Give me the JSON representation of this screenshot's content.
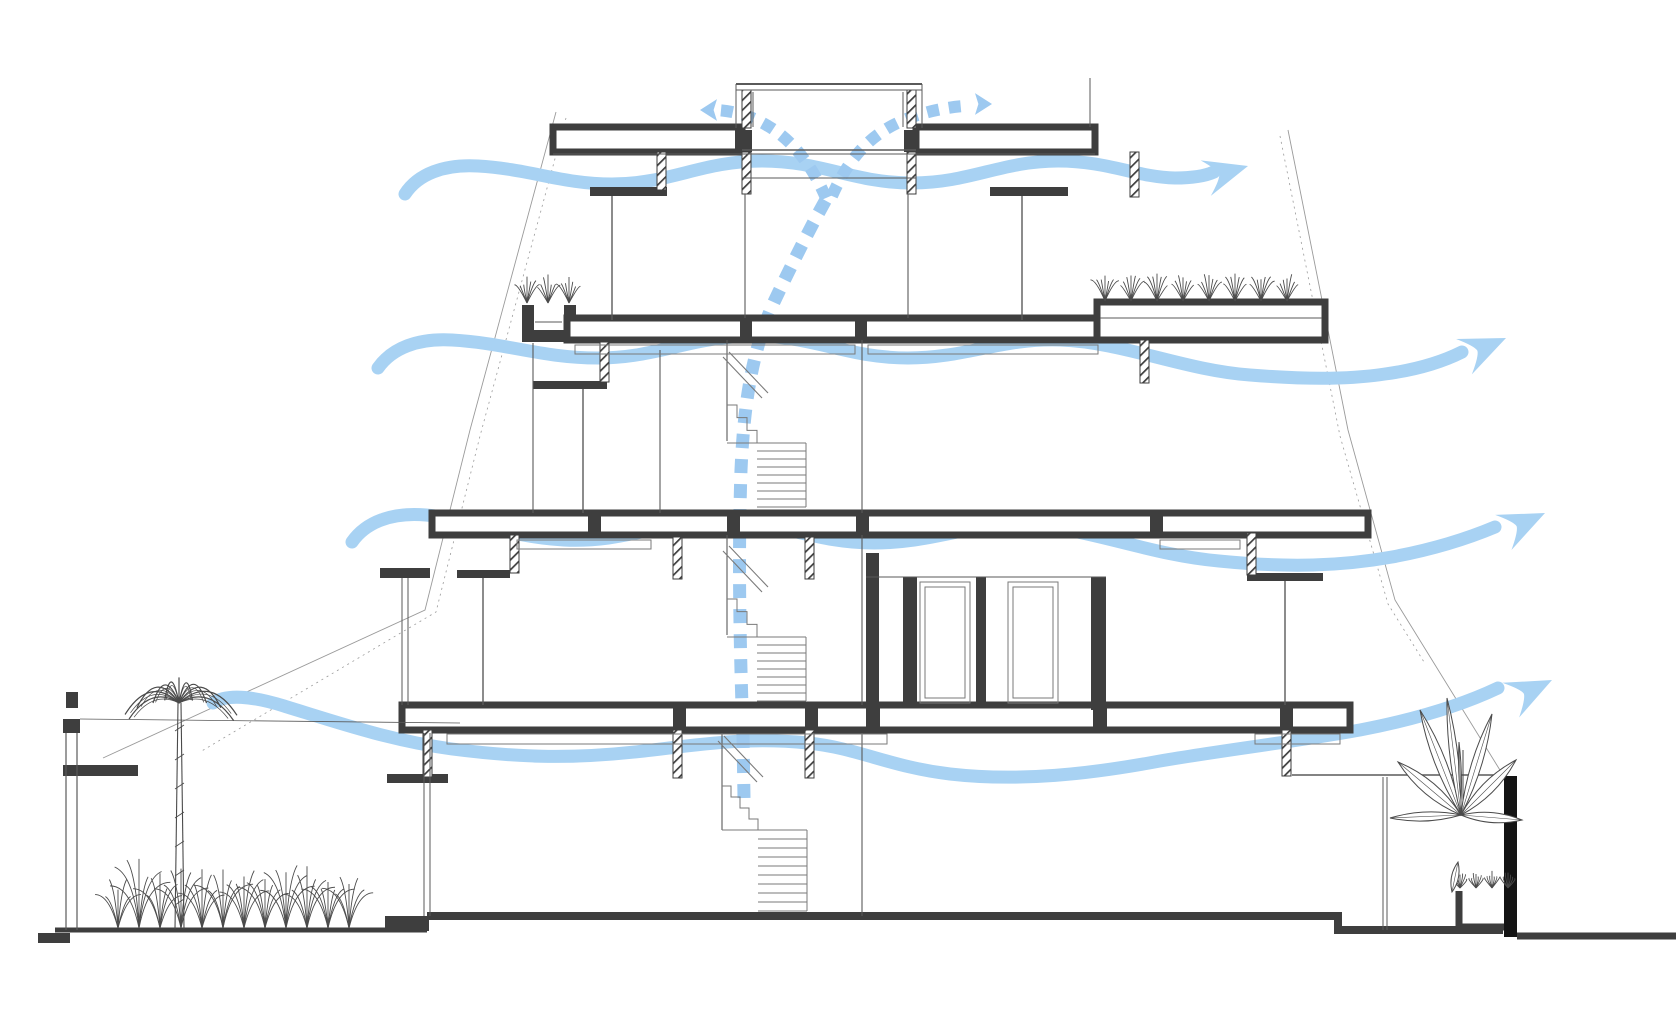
{
  "meta": {
    "title": "Building cross-section - natural ventilation diagram",
    "type": "architectural-section",
    "floors_shown": 4
  },
  "colors": {
    "background": "#FFFFFF",
    "airflow_wave": "#A8D2F3",
    "airflow_dash": "#9DC9F0",
    "structure_dark": "#3E3E3E",
    "wall_black": "#141414",
    "line_medium": "#5A5A5A",
    "line_light": "#9A9A9A",
    "stair_line": "#7A7A7A",
    "foliage": "#4A4A4A"
  },
  "airflows": {
    "waves": [
      {
        "name": "cross-ventilation-arrow-level-4",
        "d": "M405,194 C418,174 444,164 478,166 C530,169 562,184 612,184 C670,184 702,161 762,161 C822,161 854,183 912,183 C970,183 1002,161 1058,161 C1108,161 1136,177 1175,178 C1192,178 1205,176 1214,172",
        "head": {
          "x": 1248,
          "y": 166,
          "angle": -16,
          "size": 44
        }
      },
      {
        "name": "cross-ventilation-arrow-level-3",
        "d": "M378,368 C392,348 418,338 452,340 C506,343 542,358 598,358 C658,358 692,336 754,336 C814,336 848,358 908,358 C966,358 1002,338 1060,340 C1123,342 1183,370 1250,375 C1300,379 1345,380 1385,374 C1415,370 1442,362 1462,352",
        "head": {
          "x": 1506,
          "y": 338,
          "angle": -24,
          "size": 46
        }
      },
      {
        "name": "cross-ventilation-arrow-level-2",
        "d": "M352,542 C366,522 392,512 426,515 C472,519 508,537 564,540 C626,543 660,521 720,521 C780,521 814,543 874,543 C934,543 969,523 1026,525 C1089,528 1149,555 1219,561 C1289,568 1342,566 1392,557 C1430,550 1464,540 1495,527",
        "head": {
          "x": 1545,
          "y": 513,
          "angle": -25,
          "size": 46
        }
      },
      {
        "name": "cross-ventilation-arrow-ground",
        "d": "M213,703 C226,694 252,696 284,706 C336,722 388,740 452,749 C522,758 574,759 644,751 C704,744 748,737 808,743 C858,748 890,767 950,774 C1020,782 1090,774 1160,761 C1230,749 1300,741 1360,730 C1412,720 1460,706 1498,688",
        "head": {
          "x": 1552,
          "y": 680,
          "angle": -26,
          "size": 46
        }
      }
    ],
    "stack": {
      "name": "stack-ventilation-path",
      "vertical": "M744,798 L743,736 C740,650 738,560 741,470 C744,400 753,348 774,302 C792,264 812,224 828,196",
      "branch_left": "M826,198 C812,165 792,140 768,126 C752,116 734,111 716,110",
      "branch_right": "M832,196 C846,164 864,142 888,128 C908,116 938,108 964,106",
      "heads": [
        {
          "x": 700,
          "y": 110,
          "angle": 0,
          "size": 17
        },
        {
          "x": 992,
          "y": 104,
          "angle": 180,
          "size": 17
        }
      ]
    }
  },
  "drawing": {
    "slabs": [
      {
        "x": 553,
        "y": 127,
        "w": 189,
        "h": 25,
        "name": "roof-slab-left"
      },
      {
        "x": 916,
        "y": 127,
        "w": 179,
        "h": 25,
        "name": "roof-slab-right"
      },
      {
        "x": 567,
        "y": 318,
        "w": 533,
        "h": 22,
        "name": "floor-slab-level-3"
      },
      {
        "x": 1097,
        "y": 302,
        "w": 228,
        "h": 38,
        "name": "green-roof-terrace-slab"
      },
      {
        "x": 432,
        "y": 513,
        "w": 936,
        "h": 22,
        "name": "floor-slab-level-2"
      },
      {
        "x": 402,
        "y": 705,
        "w": 948,
        "h": 25,
        "name": "floor-slab-level-1"
      }
    ],
    "solids": [
      {
        "x": 735,
        "y": 130,
        "w": 17,
        "h": 22
      },
      {
        "x": 904,
        "y": 130,
        "w": 14,
        "h": 22
      },
      {
        "x": 740,
        "y": 318,
        "w": 12,
        "h": 22
      },
      {
        "x": 855,
        "y": 318,
        "w": 12,
        "h": 22
      },
      {
        "x": 588,
        "y": 513,
        "w": 13,
        "h": 22
      },
      {
        "x": 727,
        "y": 513,
        "w": 13,
        "h": 22
      },
      {
        "x": 856,
        "y": 513,
        "w": 13,
        "h": 22
      },
      {
        "x": 1150,
        "y": 513,
        "w": 13,
        "h": 22
      },
      {
        "x": 673,
        "y": 705,
        "w": 13,
        "h": 25
      },
      {
        "x": 805,
        "y": 705,
        "w": 13,
        "h": 25
      },
      {
        "x": 866,
        "y": 705,
        "w": 14,
        "h": 25
      },
      {
        "x": 1093,
        "y": 705,
        "w": 14,
        "h": 25
      },
      {
        "x": 1280,
        "y": 705,
        "w": 13,
        "h": 25
      },
      {
        "x": 590,
        "y": 187,
        "w": 77,
        "h": 9
      },
      {
        "x": 990,
        "y": 187,
        "w": 78,
        "h": 9
      },
      {
        "x": 533,
        "y": 381,
        "w": 74,
        "h": 8
      },
      {
        "x": 457,
        "y": 570,
        "w": 53,
        "h": 8
      },
      {
        "x": 380,
        "y": 568,
        "w": 50,
        "h": 10
      },
      {
        "x": 1247,
        "y": 573,
        "w": 76,
        "h": 8
      },
      {
        "x": 387,
        "y": 774,
        "w": 61,
        "h": 9
      },
      {
        "x": 866,
        "y": 553,
        "w": 13,
        "h": 154
      },
      {
        "x": 903,
        "y": 577,
        "w": 14,
        "h": 130
      },
      {
        "x": 976,
        "y": 577,
        "w": 10,
        "h": 130
      },
      {
        "x": 1091,
        "y": 577,
        "w": 15,
        "h": 133
      },
      {
        "x": 63,
        "y": 719,
        "w": 17,
        "h": 14
      },
      {
        "x": 66,
        "y": 692,
        "w": 12,
        "h": 16
      },
      {
        "x": 63,
        "y": 765,
        "w": 75,
        "h": 11
      },
      {
        "x": 38,
        "y": 933,
        "w": 32,
        "h": 10
      },
      {
        "x": 385,
        "y": 916,
        "w": 44,
        "h": 15
      },
      {
        "x": 1504,
        "y": 776,
        "w": 13,
        "h": 161,
        "black": true
      }
    ],
    "hatched": [
      {
        "x": 742,
        "y": 90,
        "w": 9,
        "h": 38
      },
      {
        "x": 907,
        "y": 90,
        "w": 9,
        "h": 38
      },
      {
        "x": 742,
        "y": 152,
        "w": 9,
        "h": 42
      },
      {
        "x": 907,
        "y": 152,
        "w": 9,
        "h": 42
      },
      {
        "x": 657,
        "y": 152,
        "w": 9,
        "h": 38
      },
      {
        "x": 1130,
        "y": 152,
        "w": 9,
        "h": 45
      },
      {
        "x": 600,
        "y": 342,
        "w": 9,
        "h": 40
      },
      {
        "x": 1140,
        "y": 340,
        "w": 9,
        "h": 43
      },
      {
        "x": 510,
        "y": 535,
        "w": 9,
        "h": 38
      },
      {
        "x": 673,
        "y": 537,
        "w": 9,
        "h": 42
      },
      {
        "x": 805,
        "y": 537,
        "w": 9,
        "h": 42
      },
      {
        "x": 1247,
        "y": 533,
        "w": 9,
        "h": 42
      },
      {
        "x": 423,
        "y": 730,
        "w": 9,
        "h": 47
      },
      {
        "x": 673,
        "y": 730,
        "w": 9,
        "h": 48
      },
      {
        "x": 805,
        "y": 730,
        "w": 9,
        "h": 48
      },
      {
        "x": 1282,
        "y": 730,
        "w": 9,
        "h": 46
      }
    ],
    "lines": [
      [
        736,
        84,
        922,
        84,
        2
      ],
      [
        736,
        90,
        922,
        90,
        1
      ],
      [
        736,
        84,
        736,
        128,
        1
      ],
      [
        922,
        84,
        922,
        128,
        1
      ],
      [
        753,
        92,
        753,
        127,
        1
      ],
      [
        903,
        92,
        903,
        127,
        1
      ],
      [
        742,
        150,
        916,
        150,
        1.4
      ],
      [
        742,
        178,
        916,
        178,
        1.1
      ],
      [
        1090,
        78,
        1090,
        127,
        1
      ],
      [
        553,
        154,
        1095,
        154,
        1
      ],
      [
        612,
        196,
        612,
        320,
        1.4
      ],
      [
        1022,
        196,
        1022,
        320,
        1.4
      ],
      [
        583,
        389,
        583,
        513,
        1.4
      ],
      [
        1285,
        581,
        1285,
        705,
        1.4
      ],
      [
        483,
        578,
        483,
        705,
        1.4
      ],
      [
        745,
        194,
        745,
        318,
        1.1
      ],
      [
        908,
        194,
        908,
        318,
        1.1
      ],
      [
        727,
        340,
        727,
        441,
        1.1
      ],
      [
        862,
        340,
        862,
        513,
        1.1
      ],
      [
        727,
        535,
        727,
        635,
        1.1
      ],
      [
        862,
        535,
        862,
        705,
        1.1
      ],
      [
        722,
        733,
        722,
        830,
        1.1
      ],
      [
        862,
        733,
        862,
        916,
        1.1
      ],
      [
        533,
        343,
        533,
        513,
        1.1
      ],
      [
        660,
        350,
        660,
        513,
        1.1
      ],
      [
        402,
        578,
        402,
        705,
        1
      ],
      [
        408,
        578,
        408,
        705,
        1
      ],
      [
        424,
        733,
        424,
        916,
        1
      ],
      [
        430,
        733,
        430,
        916,
        1
      ],
      [
        1292,
        775,
        1504,
        775,
        1.4
      ],
      [
        1383,
        777,
        1383,
        930,
        1
      ],
      [
        1387,
        777,
        1387,
        930,
        1
      ],
      [
        1100,
        318,
        1322,
        318,
        1
      ],
      [
        535,
        322,
        562,
        322,
        1
      ],
      [
        80,
        719,
        460,
        723,
        0.8
      ],
      [
        866,
        577,
        1106,
        577,
        1
      ],
      [
        66,
        733,
        66,
        930,
        1.2
      ],
      [
        77,
        733,
        77,
        930,
        1.2
      ]
    ],
    "boxes": [
      [
        575,
        345,
        280,
        9
      ],
      [
        868,
        345,
        230,
        9
      ],
      [
        517,
        540,
        134,
        9
      ],
      [
        1160,
        540,
        80,
        9
      ],
      [
        447,
        734,
        440,
        10
      ],
      [
        1255,
        734,
        85,
        10
      ],
      [
        920,
        582,
        50,
        121
      ],
      [
        925,
        587,
        40,
        111
      ],
      [
        1008,
        582,
        50,
        121
      ],
      [
        1013,
        587,
        40,
        111
      ]
    ],
    "planters": [
      {
        "pts": [
          [
            528,
            305
          ],
          [
            528,
            336
          ],
          [
            570,
            336
          ],
          [
            570,
            305
          ]
        ],
        "w": 12,
        "name": "balcony-planter-box"
      },
      {
        "pts": [
          [
            1459,
            891
          ],
          [
            1459,
            927
          ],
          [
            1512,
            927
          ]
        ],
        "w": 7,
        "name": "ground-planter-box"
      }
    ],
    "ground": [
      {
        "pts": [
          [
            427,
            916
          ],
          [
            1338,
            916
          ],
          [
            1338,
            930
          ],
          [
            1503,
            930
          ]
        ],
        "w": 8
      },
      {
        "pts": [
          [
            55,
            930
          ],
          [
            427,
            930
          ]
        ],
        "w": 5
      },
      {
        "pts": [
          [
            1517,
            936
          ],
          [
            1676,
            936
          ]
        ],
        "w": 7
      }
    ],
    "sight_lines": [
      {
        "pts": [
          [
            556,
            112
          ],
          [
            470,
            430
          ],
          [
            425,
            610
          ],
          [
            103,
            758
          ]
        ],
        "w": 0.9
      },
      {
        "pts": [
          [
            566,
            118
          ],
          [
            480,
            436
          ],
          [
            436,
            612
          ],
          [
            200,
            752
          ]
        ],
        "w": 0.8,
        "dash": "2 4"
      },
      {
        "pts": [
          [
            1288,
            130
          ],
          [
            1348,
            430
          ],
          [
            1395,
            600
          ],
          [
            1503,
            775
          ]
        ],
        "w": 0.9
      },
      {
        "pts": [
          [
            1280,
            136
          ],
          [
            1340,
            436
          ],
          [
            1388,
            604
          ],
          [
            1424,
            662
          ]
        ],
        "w": 0.8,
        "dash": "2 4"
      }
    ],
    "stairs": [
      {
        "name": "stair-flight-level-2",
        "x1": 757,
        "x2": 806,
        "yStart": 443,
        "yEnd": 507,
        "n": 8,
        "zigX": 727,
        "zigY": 405,
        "zigN": 3,
        "rail": [
          723,
          357,
          762,
          398
        ]
      },
      {
        "name": "stair-flight-level-1",
        "x1": 757,
        "x2": 806,
        "yStart": 637,
        "yEnd": 701,
        "n": 8,
        "zigX": 727,
        "zigY": 599,
        "zigN": 3,
        "rail": [
          723,
          551,
          762,
          592
        ]
      },
      {
        "name": "stair-flight-ground",
        "x1": 758,
        "x2": 807,
        "yStart": 830,
        "yEnd": 911,
        "n": 9,
        "zigX": 722,
        "zigY": 786,
        "zigN": 4,
        "rail": [
          718,
          741,
          757,
          782
        ]
      }
    ],
    "vegetation": {
      "palm": {
        "x": 179,
        "groundY": 929,
        "topY": 703,
        "frondR": 58,
        "fronds": 11
      },
      "shrub_row": {
        "x1": 118,
        "x2": 368,
        "baseY": 928,
        "spacing": 21
      },
      "roof_tufts": {
        "x1": 1105,
        "x2": 1312,
        "baseY": 301,
        "spacing": 26,
        "h": 27
      },
      "planter_tufts": {
        "x1": 527,
        "x2": 572,
        "baseY": 303,
        "spacing": 21,
        "h": 25
      },
      "rim_tufts": {
        "x1": 1460,
        "x2": 1510,
        "baseY": 888,
        "spacing": 16,
        "h": 15
      },
      "banana": {
        "stemX": 1461,
        "stemTop": 750,
        "stemBase": 815,
        "base": [
          1461,
          815
        ],
        "leaves": [
          [
            1398,
            762,
            13
          ],
          [
            1420,
            710,
            11
          ],
          [
            1447,
            698,
            8
          ],
          [
            1492,
            714,
            10
          ],
          [
            1516,
            760,
            12
          ],
          [
            1390,
            818,
            9
          ],
          [
            1522,
            820,
            10
          ]
        ],
        "bulb": [
          [
            1458,
            862
          ],
          [
            1452,
            892
          ],
          7
        ]
      }
    }
  }
}
